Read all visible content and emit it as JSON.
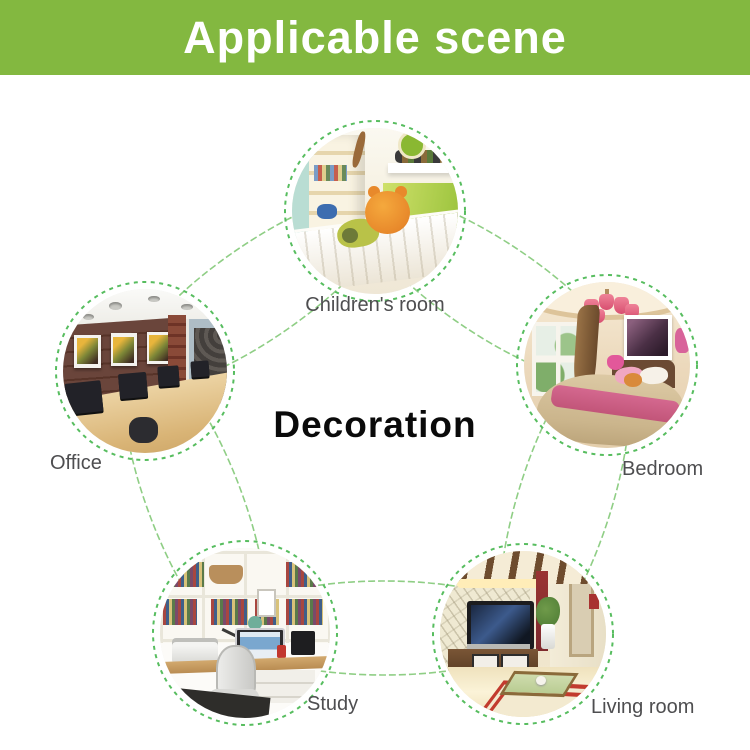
{
  "banner": {
    "title": "Applicable scene"
  },
  "center": {
    "title": "Decoration"
  },
  "scenes": [
    {
      "id": "children-room",
      "label": "Children's room"
    },
    {
      "id": "office",
      "label": "Office"
    },
    {
      "id": "bedroom",
      "label": "Bedroom"
    },
    {
      "id": "study",
      "label": "Study"
    },
    {
      "id": "living-room",
      "label": "Living room"
    }
  ],
  "colors": {
    "banner_green": "#83b840",
    "banner_text": "#ffffff",
    "connector_green": "#8fce85",
    "dash_circle_green": "#57bd5f",
    "label_gray": "#4e4e50",
    "center_title_black": "#0a0a0a"
  }
}
